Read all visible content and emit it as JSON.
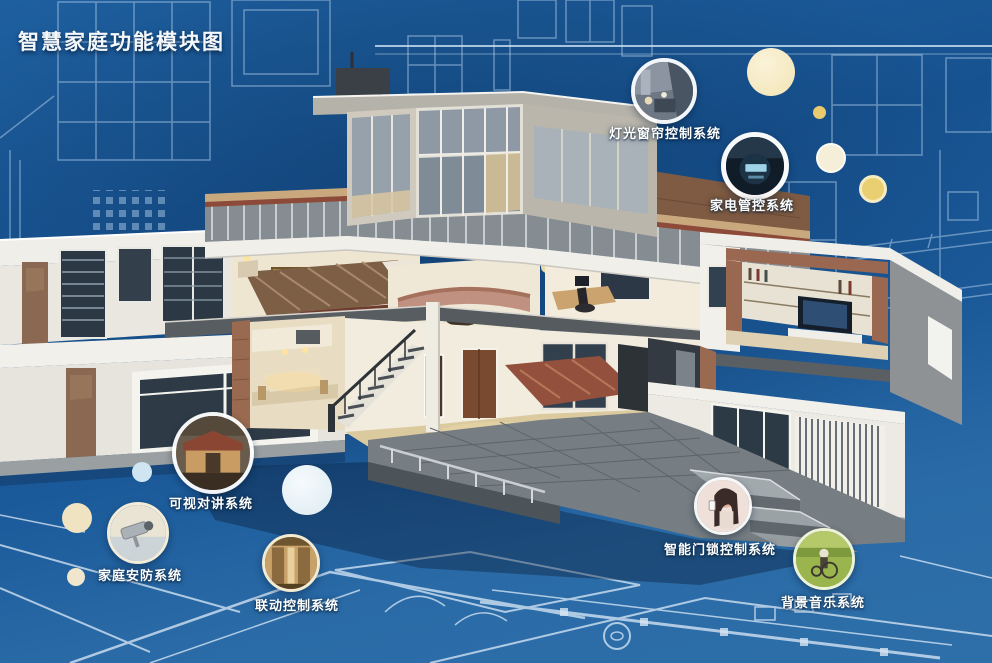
{
  "title": "智慧家庭功能模块图",
  "callouts": [
    {
      "id": "lighting-curtain-control",
      "label": "灯光窗帘控制系统"
    },
    {
      "id": "appliance-control",
      "label": "家电管控系统"
    },
    {
      "id": "video-intercom",
      "label": "可视对讲系统"
    },
    {
      "id": "home-security",
      "label": "家庭安防系统"
    },
    {
      "id": "linkage-control",
      "label": "联动控制系统"
    },
    {
      "id": "smart-door-lock-control",
      "label": "智能门锁控制系统"
    },
    {
      "id": "background-music",
      "label": "背景音乐系统"
    }
  ],
  "colors": {
    "background_blue": "#1b5a9c",
    "blueprint_line": "#cfe2f4",
    "accent_cream": "#f6ecca",
    "label_text": "#ffffff"
  }
}
